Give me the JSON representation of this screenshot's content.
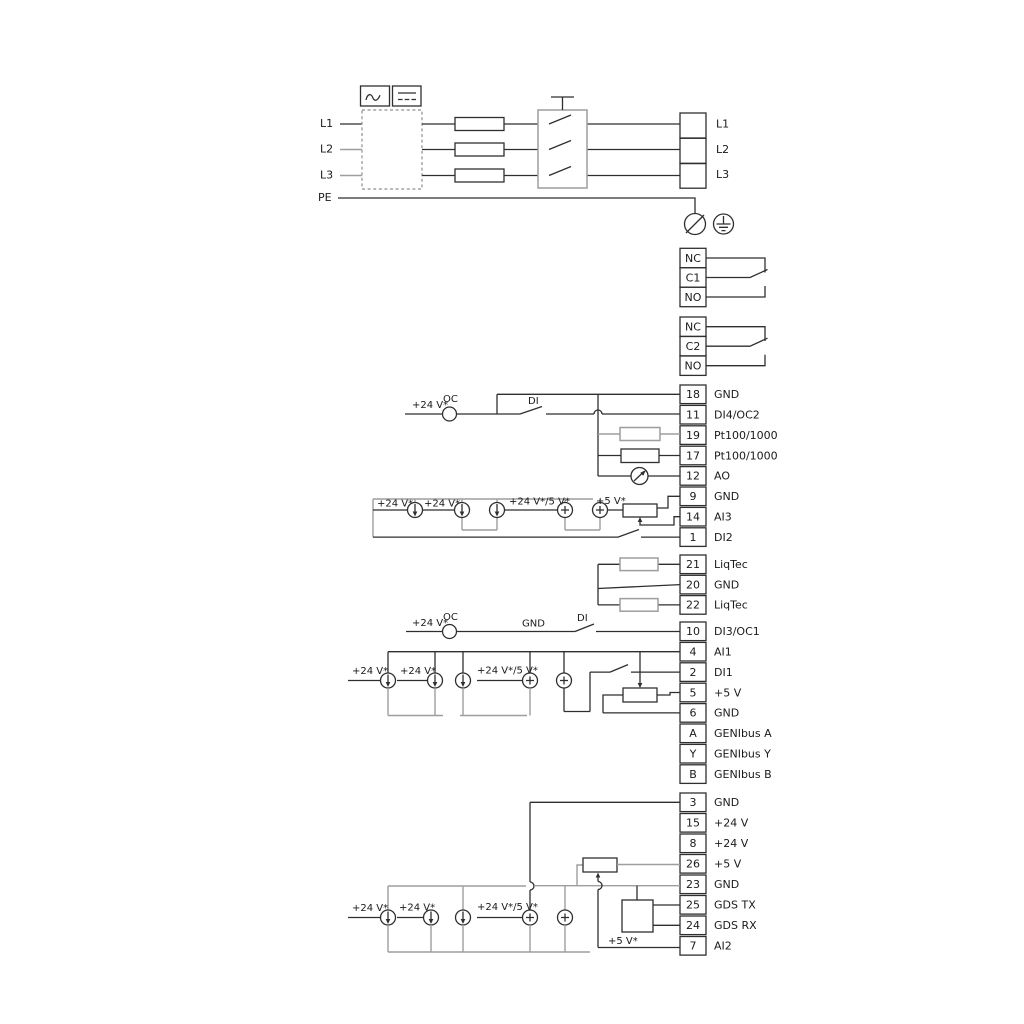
{
  "colors": {
    "background": "#ffffff",
    "wire": "#2f2f2f",
    "option_wire": "#9e9e9e",
    "text": "#1a1a1a"
  },
  "power": {
    "inputs": [
      "L1",
      "L2",
      "L3",
      "PE"
    ],
    "outputs": [
      "L1",
      "L2",
      "L3"
    ]
  },
  "relays": {
    "r1": [
      "NC",
      "C1",
      "NO"
    ],
    "r2": [
      "NC",
      "C2",
      "NO"
    ]
  },
  "strips": {
    "a": [
      {
        "n": "18",
        "l": "GND"
      },
      {
        "n": "11",
        "l": "DI4/OC2"
      },
      {
        "n": "19",
        "l": "Pt100/1000"
      },
      {
        "n": "17",
        "l": "Pt100/1000"
      },
      {
        "n": "12",
        "l": "AO"
      },
      {
        "n": "9",
        "l": "GND"
      },
      {
        "n": "14",
        "l": "AI3"
      },
      {
        "n": "1",
        "l": "DI2"
      }
    ],
    "b": [
      {
        "n": "21",
        "l": "LiqTec"
      },
      {
        "n": "20",
        "l": "GND"
      },
      {
        "n": "22",
        "l": "LiqTec"
      }
    ],
    "c": [
      {
        "n": "10",
        "l": "DI3/OC1"
      },
      {
        "n": "4",
        "l": "AI1"
      },
      {
        "n": "2",
        "l": "DI1"
      },
      {
        "n": "5",
        "l": "+5 V"
      },
      {
        "n": "6",
        "l": "GND"
      },
      {
        "n": "A",
        "l": "GENIbus A"
      },
      {
        "n": "Y",
        "l": "GENIbus Y"
      },
      {
        "n": "B",
        "l": "GENIbus B"
      }
    ],
    "d": [
      {
        "n": "3",
        "l": "GND"
      },
      {
        "n": "15",
        "l": "+24 V"
      },
      {
        "n": "8",
        "l": "+24 V"
      },
      {
        "n": "26",
        "l": "+5 V"
      },
      {
        "n": "23",
        "l": "GND"
      },
      {
        "n": "25",
        "l": "GDS TX"
      },
      {
        "n": "24",
        "l": "GDS RX"
      },
      {
        "n": "7",
        "l": "AI2"
      }
    ]
  },
  "labels": {
    "v24": "+24 V*",
    "v24_5": "+24 V*/5 V*",
    "v5": "+5 V*",
    "oc": "OC",
    "di": "DI",
    "gnd": "GND"
  }
}
